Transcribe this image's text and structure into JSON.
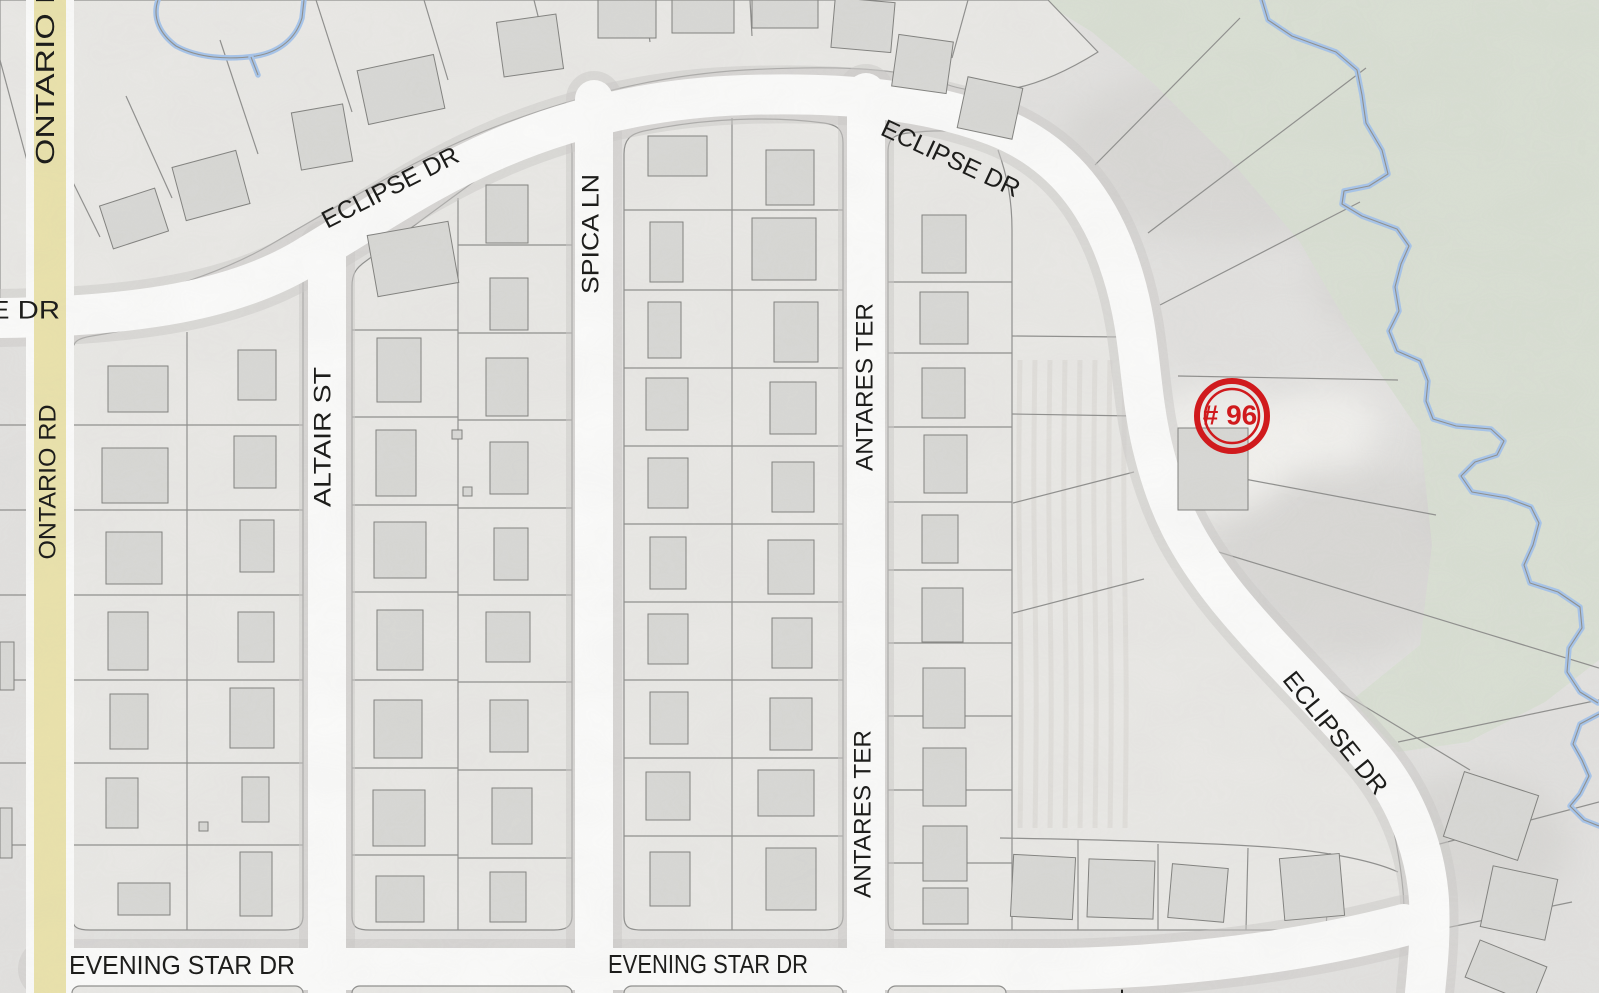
{
  "map": {
    "canvas": {
      "w": 1599,
      "h": 993
    },
    "palette": {
      "terrain": "#e2e1df",
      "block": "#e9e8e5",
      "green": "#d9dfd3",
      "road": "#fbfbfa",
      "road_casing": "#cbcac7",
      "yellow_road": "#eae2ab",
      "parcel_line": "#8f8f8d",
      "building_fill": "#d8d8d5",
      "building_stroke": "#81817e",
      "water": "#a6c4ea",
      "water_line": "#8f8f8c",
      "label": "#1d1d1b",
      "marker": "#d01a1d"
    },
    "marker": {
      "label": "# 96",
      "x": 1232,
      "y": 416,
      "r_outer": 35,
      "r_inner": 27
    },
    "labels": [
      {
        "id": "ontario-rd-top",
        "text": "ONTARIO RD",
        "x": 47,
        "y": 60,
        "rotate": -90,
        "size": 26,
        "length": 210
      },
      {
        "id": "ontario-rd",
        "text": "ONTARIO RD",
        "x": 49,
        "y": 482,
        "rotate": -90,
        "size": 24,
        "length": 155
      },
      {
        "id": "e-dr",
        "text": "E DR",
        "x": 25,
        "y": 312,
        "rotate": 0,
        "size": 25,
        "length": 70
      },
      {
        "id": "eclipse-dr-west",
        "text": "ECLIPSE DR",
        "x": 391,
        "y": 189,
        "rotate": -27,
        "size": 25,
        "length": 150
      },
      {
        "id": "eclipse-dr-north",
        "text": "ECLIPSE DR",
        "x": 950,
        "y": 160,
        "rotate": 25,
        "size": 25,
        "length": 150
      },
      {
        "id": "eclipse-dr-south",
        "text": "ECLIPSE DR",
        "x": 1334,
        "y": 734,
        "rotate": 51,
        "size": 25,
        "length": 150
      },
      {
        "id": "altair-st",
        "text": "ALTAIR ST",
        "x": 324,
        "y": 437,
        "rotate": -90,
        "size": 24,
        "length": 140
      },
      {
        "id": "spica-ln",
        "text": "SPICA LN",
        "x": 592,
        "y": 234,
        "rotate": -90,
        "size": 24,
        "length": 120
      },
      {
        "id": "antares-ter-north",
        "text": "ANTARES TER",
        "x": 866,
        "y": 387,
        "rotate": -90,
        "size": 24,
        "length": 168
      },
      {
        "id": "antares-ter-south",
        "text": "ANTARES TER",
        "x": 864,
        "y": 814,
        "rotate": -90,
        "size": 24,
        "length": 168
      },
      {
        "id": "evening-star-dr-west",
        "text": "EVENING STAR DR",
        "x": 182,
        "y": 967,
        "rotate": 0,
        "size": 26,
        "length": 226
      },
      {
        "id": "evening-star-dr-east",
        "text": "EVENING STAR DR",
        "x": 708,
        "y": 966,
        "rotate": 0,
        "size": 26,
        "length": 200
      },
      {
        "id": "street-label-fragment",
        "text": "T",
        "x": 1132,
        "y": 998,
        "rotate": -90,
        "size": 26,
        "length": 18
      }
    ],
    "green_areas": [
      "M 1040 0 L 1599 0 L 1599 660 L 1545 702 L 1468 742 L 1398 752 L 1352 700 L 1420 645 L 1432 545 L 1420 432 L 1352 332 L 1300 242 L 1232 162 L 1152 82 L 1092 32 Z",
      "M 78 0 L 310 0 L 310 26 C 300 52 268 60 240 62 C 215 64 190 58 172 62 C 150 66 128 82 108 96 C 94 106 84 110 78 112 Z"
    ],
    "blocks": [
      "M 0 0 L 1048 0 L 1098 52 C 1040 88 990 102 940 82 C 890 66 820 66 745 70 C 660 75 580 95 500 125 C 420 155 340 205 270 245 C 200 285 100 310 0 318 Z",
      "M 72 916 L 72 354 C 72 340 80 338 92 336 C 170 324 240 300 292 272 C 300 268 303 272 303 282 L 303 916 C 303 928 295 930 285 930 L 90 930 C 78 930 72 928 72 916 Z",
      "M 352 916 L 352 286 C 352 274 356 268 366 261 L 544 130 C 554 122 560 124 565 130 C 570 136 572 142 572 154 L 572 916 C 572 928 564 930 554 930 L 370 930 C 358 930 352 928 352 916 Z",
      "M 624 916 L 624 154 C 624 140 630 134 644 131 C 706 118 770 116 824 123 C 838 125 843 130 843 143 L 843 916 C 843 928 835 930 825 930 L 642 930 C 630 930 624 928 624 916 Z",
      "M 888 916 L 888 152 C 888 138 894 135 908 133 C 950 128 978 132 1000 142 C 1048 160 1082 194 1104 234 C 1122 266 1130 304 1136 342 C 1142 382 1144 412 1152 448 C 1162 498 1182 540 1212 580 C 1244 622 1292 668 1336 720 C 1368 758 1388 800 1396 842 C 1402 874 1404 896 1404 912 C 1404 926 1396 930 1386 930 L 894 930 C 888 930 888 922 888 916 Z"
    ],
    "parcel_lines": [
      "M 187 332 L 187 930",
      "M 72 425 L 303 425",
      "M 72 510 L 303 510",
      "M 72 595 L 303 595",
      "M 72 680 L 303 680",
      "M 72 763 L 303 763",
      "M 72 845 L 303 845",
      "M 458 198 L 458 930",
      "M 352 330 L 458 330",
      "M 352 417 L 458 417",
      "M 352 505 L 458 505",
      "M 352 592 L 458 592",
      "M 352 680 L 458 680",
      "M 352 768 L 458 768",
      "M 352 855 L 458 855",
      "M 458 245 L 572 245",
      "M 458 333 L 572 333",
      "M 458 420 L 572 420",
      "M 458 508 L 572 508",
      "M 458 595 L 572 595",
      "M 458 682 L 572 682",
      "M 458 770 L 572 770",
      "M 458 858 L 572 858",
      "M 732 118 L 732 930",
      "M 624 210 L 843 210",
      "M 624 290 L 843 290",
      "M 624 368 L 843 368",
      "M 624 446 L 843 446",
      "M 624 524 L 843 524",
      "M 624 602 L 843 602",
      "M 624 680 L 843 680",
      "M 624 758 L 843 758",
      "M 624 836 L 843 836",
      "M 998 150 C 1008 178 1012 202 1012 230 L 1012 930",
      "M 888 282 L 1012 282",
      "M 888 353 L 1012 353",
      "M 888 427 L 1012 427",
      "M 888 502 L 1012 502",
      "M 888 570 L 1012 570",
      "M 888 643 L 1012 643",
      "M 888 716 L 1012 716",
      "M 888 790 L 1012 790",
      "M 888 863 L 1012 863",
      "M 1012 336 L 1124 337",
      "M 1012 414 L 1134 416",
      "M 1013 503 L 1134 472",
      "M 1013 613 L 1144 579",
      "M 1000 838 C 1120 840 1250 844 1302 850 C 1342 855 1376 862 1398 872",
      "M 1078 840 L 1078 930",
      "M 1158 844 L 1158 930",
      "M 1248 848 L 1246 930",
      "M 1330 853 L 1326 930",
      "M 30 218 L 30 930",
      "M 0 425 L 30 425",
      "M 0 510 L 30 510",
      "M 0 595 L 30 595",
      "M 0 680 L 30 680",
      "M 0 763 L 30 763",
      "M 0 845 L 30 845",
      "M 0 60 L 30 172",
      "M 100 237 L 52 140",
      "M 172 198 L 126 96",
      "M 258 154 L 220 40",
      "M 352 112 L 316 0",
      "M 448 80 L 424 0",
      "M 548 56 L 534 0",
      "M 650 42 L 644 0",
      "M 752 36 L 750 0",
      "M 852 40 L 856 0",
      "M 952 58 L 968 0",
      "M 1095 165 L 1240 18",
      "M 1148 233 L 1366 68",
      "M 1160 305 L 1360 202",
      "M 1178 376 L 1398 380",
      "M 1186 468 L 1436 515",
      "M 1212 550 L 1599 668",
      "M 1268 648 L 1470 770",
      "M 1398 742 L 1599 700",
      "M 1432 846 L 1599 802",
      "M 1436 930 L 1572 902"
    ],
    "field_stripes": {
      "x0": 1020,
      "x1": 1126,
      "step": 15,
      "y0": 360,
      "y1": 828
    },
    "water": {
      "stream": "M 1262 0 L 1268 20 L 1292 36 L 1336 52 L 1357 70 L 1362 95 L 1366 123 L 1382 150 L 1388 174 L 1369 186 L 1344 191 L 1342 204 L 1362 216 L 1397 229 L 1409 246 L 1401 264 L 1395 287 L 1399 311 L 1389 331 L 1397 351 L 1420 361 L 1428 381 L 1426 401 L 1433 419 L 1456 426 L 1491 429 L 1504 441 L 1497 455 L 1475 462 L 1461 476 L 1472 492 L 1507 498 L 1531 507 L 1539 523 L 1533 545 L 1524 565 L 1530 583 L 1558 592 L 1580 607 L 1582 628 L 1569 648 L 1567 672 L 1580 692 L 1598 703",
      "stream2": "M 1599 714 L 1580 724 L 1573 744 L 1582 760 L 1589 776 L 1580 794 L 1570 806 L 1584 820 L 1599 826",
      "pond": "M 158 0 C 152 18 160 34 176 46 C 198 58 228 60 256 56 C 280 52 296 38 302 18 L 304 0",
      "pond_stub": "M 251 57 L 258 75"
    },
    "roads": {
      "white": [
        {
          "name": "eclipse-dr",
          "path": "M 0 318 C 140 316 235 300 305 258 C 380 213 430 178 500 148 C 575 116 655 98 745 95 C 840 92 925 99 995 126 C 1065 153 1102 208 1122 272 C 1142 335 1138 385 1152 445 C 1167 508 1188 548 1228 598 C 1272 652 1330 707 1374 760 C 1410 804 1426 856 1429 900 C 1431 940 1427 970 1425 993",
          "width": 40
        },
        {
          "name": "altair-st",
          "path": "M 327 248 L 327 993",
          "width": 38
        },
        {
          "name": "spica-ln",
          "path": "M 594 99 L 594 993",
          "width": 38
        },
        {
          "name": "antares-ter",
          "path": "M 866 92 L 866 993",
          "width": 38
        },
        {
          "name": "evening-star-dr",
          "path": "M 48 969 L 1060 969 C 1180 967 1300 952 1404 925",
          "width": 42
        }
      ],
      "yellow": {
        "name": "ontario-rd",
        "path": "M 50 0 L 50 993",
        "width": 32,
        "casing_width": 48
      }
    },
    "bottom_slivers": [
      [
        72,
        986,
        231,
        14
      ],
      [
        352,
        986,
        220,
        14
      ],
      [
        624,
        986,
        219,
        14
      ],
      [
        888,
        986,
        118,
        14
      ]
    ],
    "hillshade": {
      "dark": [
        [
          1230,
          150,
          170,
          90
        ],
        [
          1430,
          270,
          120,
          85
        ],
        [
          1340,
          560,
          130,
          100
        ],
        [
          1510,
          470,
          90,
          120
        ],
        [
          1470,
          120,
          110,
          70
        ],
        [
          1150,
          640,
          50,
          150
        ],
        [
          1480,
          840,
          90,
          70
        ]
      ],
      "light": [
        [
          1215,
          452,
          80,
          62
        ],
        [
          1050,
          300,
          55,
          110
        ],
        [
          1320,
          430,
          60,
          40
        ]
      ]
    },
    "buildings": [
      [
        105,
        196,
        58,
        45,
        -18
      ],
      [
        178,
        158,
        66,
        55,
        -15
      ],
      [
        296,
        108,
        52,
        58,
        -10
      ],
      [
        362,
        62,
        78,
        55,
        -12
      ],
      [
        500,
        18,
        60,
        55,
        -8
      ],
      [
        598,
        0,
        58,
        38,
        0
      ],
      [
        672,
        0,
        62,
        33,
        0
      ],
      [
        752,
        0,
        66,
        28,
        0
      ],
      [
        833,
        0,
        60,
        50,
        5
      ],
      [
        895,
        38,
        55,
        52,
        8
      ],
      [
        962,
        82,
        56,
        52,
        12
      ],
      [
        0,
        642,
        14,
        48,
        0
      ],
      [
        0,
        808,
        12,
        50,
        0
      ],
      [
        108,
        366,
        60,
        46,
        0
      ],
      [
        102,
        448,
        66,
        55,
        0
      ],
      [
        106,
        532,
        56,
        52,
        0
      ],
      [
        108,
        612,
        40,
        58,
        0
      ],
      [
        110,
        694,
        38,
        55,
        0
      ],
      [
        106,
        778,
        32,
        50,
        0
      ],
      [
        118,
        883,
        52,
        32,
        0
      ],
      [
        238,
        350,
        38,
        50,
        0
      ],
      [
        234,
        436,
        42,
        52,
        0
      ],
      [
        240,
        520,
        34,
        52,
        0
      ],
      [
        238,
        612,
        36,
        50,
        0
      ],
      [
        230,
        688,
        44,
        60,
        0
      ],
      [
        242,
        777,
        27,
        45,
        0
      ],
      [
        240,
        852,
        32,
        64,
        0
      ],
      [
        199,
        822,
        9,
        9,
        0
      ],
      [
        372,
        228,
        82,
        62,
        -10
      ],
      [
        377,
        338,
        44,
        64,
        0
      ],
      [
        376,
        430,
        40,
        66,
        0
      ],
      [
        374,
        522,
        52,
        56,
        0
      ],
      [
        377,
        610,
        46,
        60,
        0
      ],
      [
        374,
        700,
        48,
        58,
        0
      ],
      [
        373,
        790,
        52,
        56,
        0
      ],
      [
        376,
        876,
        48,
        46,
        0
      ],
      [
        486,
        185,
        42,
        58,
        0
      ],
      [
        490,
        278,
        38,
        52,
        0
      ],
      [
        486,
        358,
        42,
        58,
        0
      ],
      [
        490,
        442,
        38,
        52,
        0
      ],
      [
        494,
        528,
        34,
        52,
        0
      ],
      [
        486,
        612,
        44,
        50,
        0
      ],
      [
        490,
        700,
        38,
        52,
        0
      ],
      [
        492,
        788,
        40,
        56,
        0
      ],
      [
        490,
        872,
        36,
        50,
        0
      ],
      [
        452,
        430,
        10,
        9,
        0
      ],
      [
        463,
        487,
        9,
        9,
        0
      ],
      [
        648,
        136,
        59,
        40,
        0
      ],
      [
        650,
        222,
        33,
        60,
        0
      ],
      [
        648,
        302,
        33,
        56,
        0
      ],
      [
        646,
        378,
        42,
        52,
        0
      ],
      [
        648,
        458,
        40,
        50,
        0
      ],
      [
        650,
        537,
        36,
        52,
        0
      ],
      [
        648,
        614,
        40,
        50,
        0
      ],
      [
        650,
        692,
        38,
        52,
        0
      ],
      [
        646,
        772,
        44,
        48,
        0
      ],
      [
        650,
        852,
        40,
        54,
        0
      ],
      [
        766,
        150,
        48,
        55,
        0
      ],
      [
        752,
        218,
        64,
        62,
        0
      ],
      [
        774,
        302,
        44,
        60,
        0
      ],
      [
        770,
        382,
        46,
        52,
        0
      ],
      [
        772,
        462,
        42,
        50,
        0
      ],
      [
        768,
        540,
        46,
        54,
        0
      ],
      [
        772,
        618,
        40,
        50,
        0
      ],
      [
        770,
        698,
        42,
        52,
        0
      ],
      [
        758,
        770,
        56,
        46,
        0
      ],
      [
        766,
        848,
        50,
        62,
        0
      ],
      [
        922,
        215,
        44,
        58,
        0
      ],
      [
        920,
        292,
        48,
        52,
        0
      ],
      [
        922,
        368,
        43,
        50,
        0
      ],
      [
        924,
        435,
        43,
        58,
        0
      ],
      [
        922,
        515,
        36,
        48,
        0
      ],
      [
        922,
        588,
        41,
        54,
        0
      ],
      [
        923,
        668,
        42,
        60,
        0
      ],
      [
        923,
        748,
        43,
        58,
        0
      ],
      [
        923,
        826,
        44,
        55,
        0
      ],
      [
        923,
        888,
        45,
        36,
        0
      ],
      [
        1178,
        428,
        70,
        82,
        0
      ],
      [
        1012,
        856,
        62,
        62,
        3
      ],
      [
        1088,
        860,
        66,
        58,
        2
      ],
      [
        1170,
        866,
        56,
        54,
        5
      ],
      [
        1282,
        856,
        60,
        62,
        -5
      ],
      [
        1452,
        782,
        78,
        68,
        18
      ],
      [
        1486,
        872,
        66,
        62,
        12
      ],
      [
        1470,
        952,
        72,
        40,
        22
      ]
    ]
  }
}
